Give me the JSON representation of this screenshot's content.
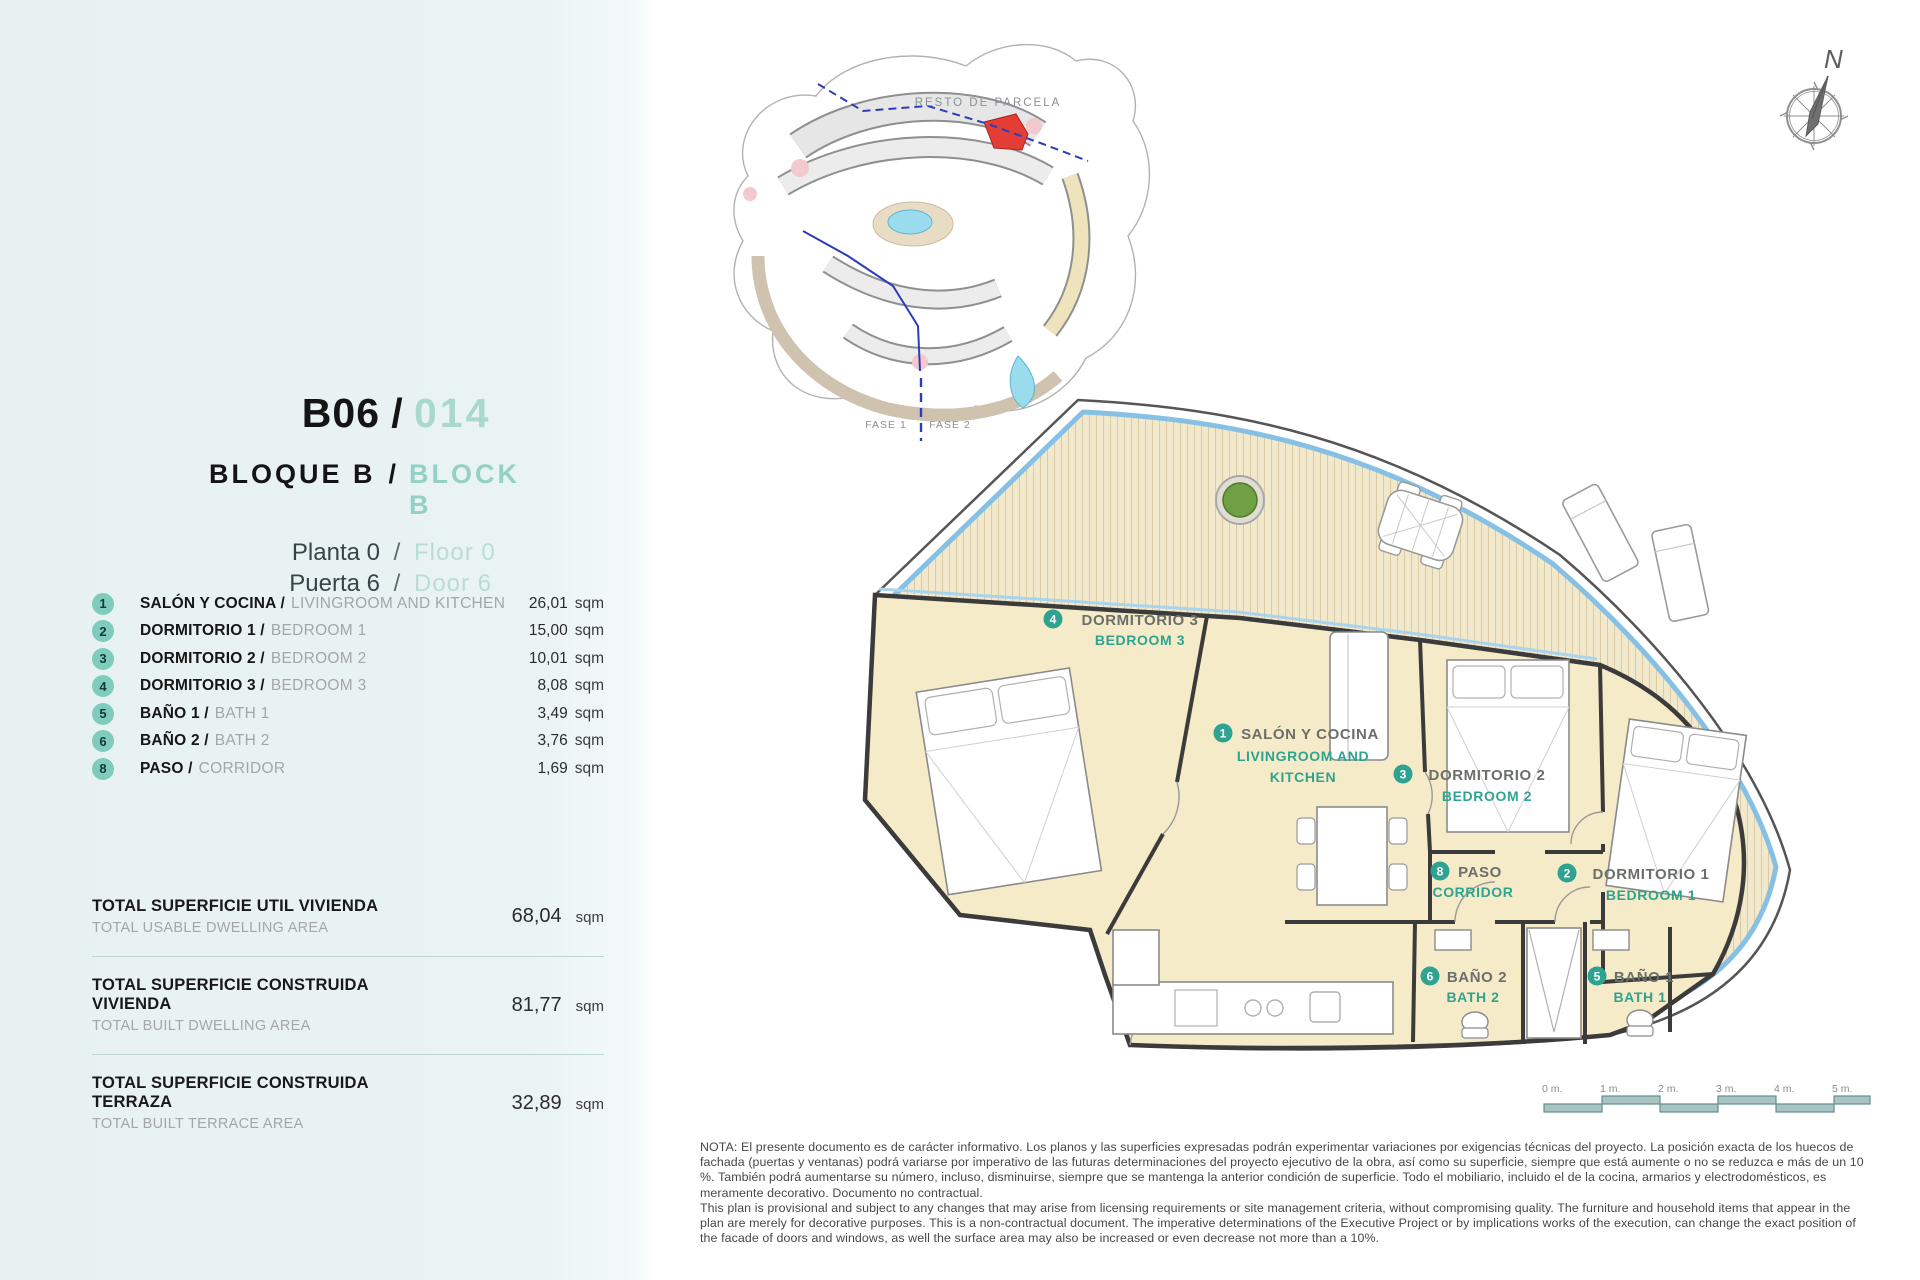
{
  "sep": "/",
  "unit": {
    "code": "B06",
    "number": "014",
    "block_es": "BLOQUE B",
    "block_en": "BLOCK B",
    "floor_es": "Planta 0",
    "floor_en": "Floor 0",
    "door_es": "Puerta 6",
    "door_en": "Door 6"
  },
  "area_unit": "sqm",
  "rooms": [
    {
      "num": "1",
      "es": "SALÓN Y COCINA /",
      "en": "LIVINGROOM AND KITCHEN",
      "area": "26,01"
    },
    {
      "num": "2",
      "es": "DORMITORIO 1 /",
      "en": "BEDROOM 1",
      "area": "15,00"
    },
    {
      "num": "3",
      "es": "DORMITORIO 2 /",
      "en": "BEDROOM 2",
      "area": "10,01"
    },
    {
      "num": "4",
      "es": "DORMITORIO 3 /",
      "en": "BEDROOM 3",
      "area": "8,08"
    },
    {
      "num": "5",
      "es": "BAÑO 1 /",
      "en": "BATH 1",
      "area": "3,49"
    },
    {
      "num": "6",
      "es": "BAÑO 2 /",
      "en": "BATH 2",
      "area": "3,76"
    },
    {
      "num": "8",
      "es": "PASO /",
      "en": "CORRIDOR",
      "area": "1,69"
    }
  ],
  "totals": [
    {
      "es": "TOTAL SUPERFICIE UTIL VIVIENDA",
      "en": "TOTAL USABLE DWELLING AREA",
      "value": "68,04"
    },
    {
      "es": "TOTAL SUPERFICIE CONSTRUIDA VIVIENDA",
      "en": "TOTAL BUILT DWELLING AREA",
      "value": "81,77"
    },
    {
      "es": "TOTAL SUPERFICIE CONSTRUIDA TERRAZA",
      "en": "TOTAL BUILT TERRACE AREA",
      "value": "32,89"
    }
  ],
  "site_plan": {
    "area_label": "RESTO DE PARCELA",
    "phase1": "FASE 1",
    "phase2": "FASE 2"
  },
  "compass": {
    "north": "N"
  },
  "plan": {
    "labels": [
      {
        "num": "4",
        "es": "DORMITORIO 3",
        "en": "BEDROOM 3"
      },
      {
        "num": "1",
        "es": "SALÓN Y COCINA",
        "en1": "LIVINGROOM AND",
        "en2": "KITCHEN"
      },
      {
        "num": "3",
        "es": "DORMITORIO 2",
        "en": "BEDROOM 2"
      },
      {
        "num": "8",
        "es": "PASO",
        "en": "CORRIDOR"
      },
      {
        "num": "2",
        "es": "DORMITORIO 1",
        "en": "BEDROOM 1"
      },
      {
        "num": "6",
        "es": "BAÑO 2",
        "en": "BATH 2"
      },
      {
        "num": "5",
        "es": "BAÑO 1",
        "en": "BATH 1"
      }
    ]
  },
  "scale_bar": {
    "ticks": [
      "0 m.",
      "1 m.",
      "2 m.",
      "3 m.",
      "4 m.",
      "5 m."
    ]
  },
  "note": {
    "es": "NOTA: El presente documento es de carácter informativo. Los planos y las superficies expresadas podrán experimentar variaciones por exigencias técnicas del proyecto. La posición exacta de los huecos de fachada (puertas y ventanas) podrá variarse por imperativo de las futuras determinaciones del proyecto ejecutivo de la obra, así como su superficie, siempre que está aumente o no se reduzca e más de un 10 %. También podrá aumentarse su número, incluso, disminuirse, siempre que se mantenga la anterior condición de superficie. Todo el mobiliario, incluido el de la cocina, armarios y electrodomésticos, es meramente decorativo. Documento no contractual.",
    "en": "This plan is provisional and subject to any changes that may arise from licensing requirements or site management criteria, without compromising quality. The furniture and household items that appear in the plan are merely for decorative purposes. This is a non-contractual document. The imperative determinations of the Executive Project or by implications works of the execution, can change the exact position of the facade of doors and windows, as well the surface area may also be increased or even decrease not more than a 10%."
  },
  "colors": {
    "accent_teal": "#2fa392",
    "light_teal": "#7fccbc",
    "pale_teal_text": "#a9d8cf",
    "sidebar_bg": "#e9f3f3",
    "room_floor": "#f6ebc8",
    "deck_stripe": "#d8cba6",
    "water_blue": "#86c0e5",
    "highlight_red": "#e33d35",
    "wall": "#3b3b3b"
  }
}
